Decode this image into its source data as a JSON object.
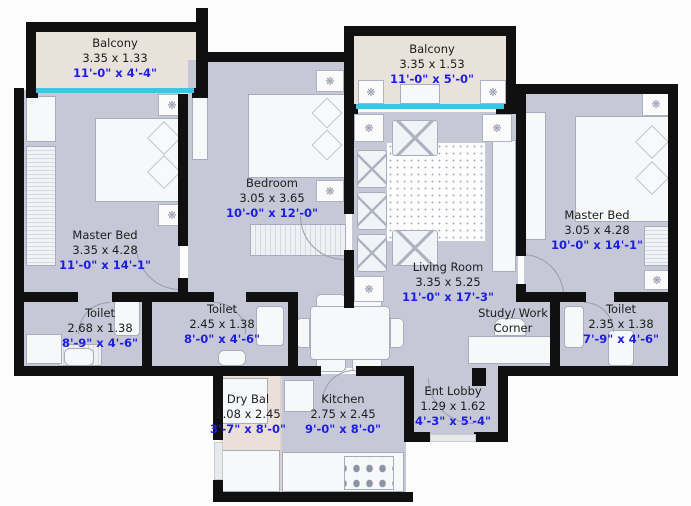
{
  "colors": {
    "wall": "#101010",
    "floor": "#c6c8d7",
    "balcony_floor": "#e9e2da",
    "dry_balcony_floor": "#eadfd9",
    "window": "#45c1e3",
    "dimension_text": "#1d1de0",
    "label_text": "#1c1c1c"
  },
  "icons": {
    "fan": "❋"
  },
  "rooms": {
    "balcony_tl": {
      "name": "Balcony",
      "metric": "3.35 x 1.33",
      "imperial": "11'-0\" x 4'-4\""
    },
    "balcony_tr": {
      "name": "Balcony",
      "metric": "3.35 x 1.53",
      "imperial": "11'-0\" x 5'-0\""
    },
    "master_left": {
      "name": "Master Bed",
      "metric": "3.35 x 4.28",
      "imperial": "11'-0\" x 14'-1\""
    },
    "bedroom": {
      "name": "Bedroom",
      "metric": "3.05 x 3.65",
      "imperial": "10'-0\" x 12'-0\""
    },
    "master_right": {
      "name": "Master Bed",
      "metric": "3.05 x 4.28",
      "imperial": "10'-0\" x 14'-1\""
    },
    "living": {
      "name": "Living Room",
      "metric": "3.35 x 5.25",
      "imperial": "11'-0\" x 17'-3\""
    },
    "toilet_left": {
      "name": "Toilet",
      "metric": "2.68 x 1.38",
      "imperial": "8'-9\" x 4'-6\""
    },
    "toilet_center": {
      "name": "Toilet",
      "metric": "2.45 x 1.38",
      "imperial": "8'-0\" x 4'-6\""
    },
    "toilet_right": {
      "name": "Toilet",
      "metric": "2.35 x 1.38",
      "imperial": "7'-9\" x 4'-6\""
    },
    "study": {
      "name": "Study/ Work Corner"
    },
    "dry_bal": {
      "name": "Dry Bal",
      "metric": "1.08 x 2.45",
      "imperial": "3'-7\" x 8'-0\""
    },
    "kitchen": {
      "name": "Kitchen",
      "metric": "2.75 x 2.45",
      "imperial": "9'-0\" x 8'-0\""
    },
    "ent_lobby": {
      "name": "Ent Lobby",
      "metric": "1.29 x 1.62",
      "imperial": "4'-3\" x 5'-4\""
    }
  }
}
